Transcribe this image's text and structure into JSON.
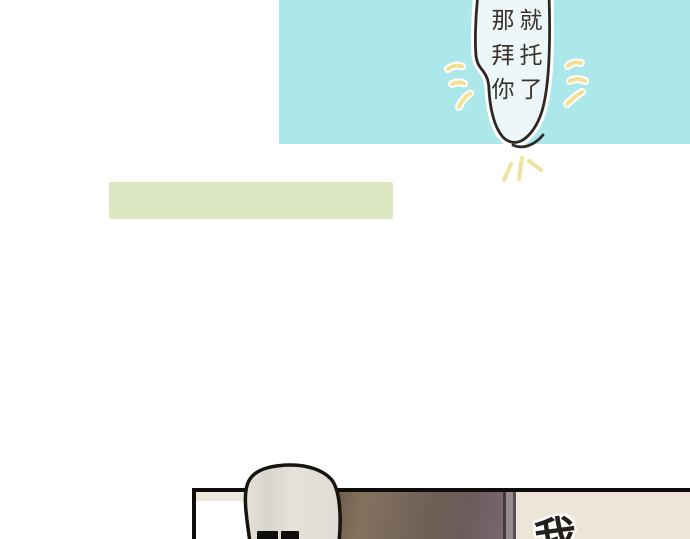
{
  "comic": {
    "top_panel": {
      "bg_color": "#ace7ea"
    },
    "speech_bubble": {
      "full_text": "那就拜托你了",
      "lines": [
        "那就",
        "拜托",
        "你了"
      ],
      "fill_color": "#edf7fa",
      "outline_color": "#2d2823",
      "sparkle_color": "#f2e193"
    },
    "green_bar": {
      "color": "#dde7c2"
    },
    "bottom_panel": {
      "border_color": "#0f0d0b",
      "wall_color": "#ece7db",
      "door_color": "#72625a",
      "right_wall_color": "#ede6d8",
      "partial_text": "我"
    },
    "character": {
      "head_fill": "#e2ded7",
      "outline_color": "#17130f"
    }
  }
}
